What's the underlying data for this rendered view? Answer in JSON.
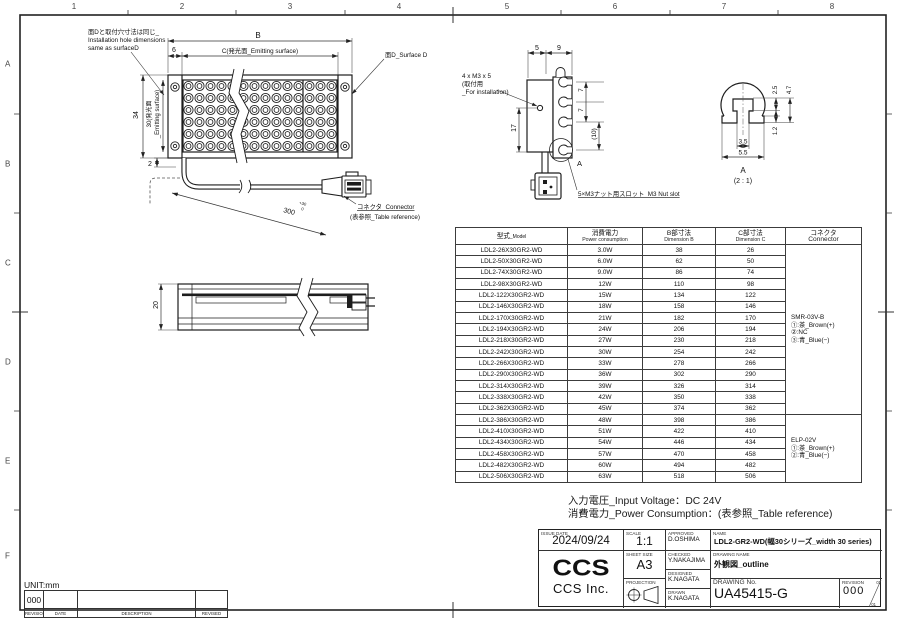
{
  "frame": {
    "col_labels": [
      "1",
      "2",
      "3",
      "4",
      "5",
      "6",
      "7",
      "8"
    ],
    "row_labels": [
      "A",
      "B",
      "C",
      "D",
      "E",
      "F"
    ]
  },
  "labels": {
    "install_note_1": "面Dと取付穴寸法は同じ_",
    "install_note_2": "Installation hole dimensions",
    "install_note_3": "same as surfaceD",
    "surface_d": "面D_Surface D",
    "connector": "コネクタ_Connector",
    "connector_ref": "(表参照_Table reference)",
    "m3_1": "4 x M3 x 5",
    "m3_2": "(取付用",
    "m3_3": "_For installation)",
    "nut_slot": "5×M3ナット用スロット_M3 Nut slot",
    "section_a": "A",
    "detail_a": "A",
    "detail_scale": "(2 : 1)"
  },
  "dims": {
    "b": "B",
    "c": "C(発光面_Emitting surface)",
    "offset6": "6",
    "h34": "34",
    "h30_l1": "30(発光面",
    "h30_l2": "_Emitting surface)",
    "h2": "2",
    "cable_len": "300",
    "cable_tol_up": "+30",
    "cable_tol_dn": "0",
    "t20": "20",
    "s5": "5",
    "s9": "9",
    "s17": "17",
    "s7a": "7",
    "s7b": "7",
    "s10": "(10)",
    "d25": "2.5",
    "d47": "4.7",
    "d12": "1.2",
    "d35": "3.5",
    "d55": "5.5"
  },
  "table": {
    "headers": [
      {
        "jp": "型式",
        "en": "_Model"
      },
      {
        "jp": "消費電力",
        "en": "Power consumption"
      },
      {
        "jp": "B部寸法",
        "en": "Dimension B"
      },
      {
        "jp": "C部寸法",
        "en": "Dimension C"
      },
      {
        "jp": "コネクタ",
        "en": "Connector"
      }
    ],
    "rows": [
      [
        "LDL2-26X30GR2-WD",
        "3.0W",
        "38",
        "26"
      ],
      [
        "LDL2-50X30GR2-WD",
        "6.0W",
        "62",
        "50"
      ],
      [
        "LDL2-74X30GR2-WD",
        "9.0W",
        "86",
        "74"
      ],
      [
        "LDL2-98X30GR2-WD",
        "12W",
        "110",
        "98"
      ],
      [
        "LDL2-122X30GR2-WD",
        "15W",
        "134",
        "122"
      ],
      [
        "LDL2-146X30GR2-WD",
        "18W",
        "158",
        "146"
      ],
      [
        "LDL2-170X30GR2-WD",
        "21W",
        "182",
        "170"
      ],
      [
        "LDL2-194X30GR2-WD",
        "24W",
        "206",
        "194"
      ],
      [
        "LDL2-218X30GR2-WD",
        "27W",
        "230",
        "218"
      ],
      [
        "LDL2-242X30GR2-WD",
        "30W",
        "254",
        "242"
      ],
      [
        "LDL2-266X30GR2-WD",
        "33W",
        "278",
        "266"
      ],
      [
        "LDL2-290X30GR2-WD",
        "36W",
        "302",
        "290"
      ],
      [
        "LDL2-314X30GR2-WD",
        "39W",
        "326",
        "314"
      ],
      [
        "LDL2-338X30GR2-WD",
        "42W",
        "350",
        "338"
      ],
      [
        "LDL2-362X30GR2-WD",
        "45W",
        "374",
        "362"
      ],
      [
        "LDL2-386X30GR2-WD",
        "48W",
        "398",
        "386"
      ],
      [
        "LDL2-410X30GR2-WD",
        "51W",
        "422",
        "410"
      ],
      [
        "LDL2-434X30GR2-WD",
        "54W",
        "446",
        "434"
      ],
      [
        "LDL2-458X30GR2-WD",
        "57W",
        "470",
        "458"
      ],
      [
        "LDL2-482X30GR2-WD",
        "60W",
        "494",
        "482"
      ],
      [
        "LDL2-506X30GR2-WD",
        "63W",
        "518",
        "506"
      ]
    ],
    "connector_groups": [
      {
        "span": 15,
        "lines": [
          "SMR-03V-B",
          "①:茶_Brown(+)",
          "②:NC",
          "③:青_Blue(−)"
        ]
      },
      {
        "span": 6,
        "lines": [
          "ELP-02V",
          "①:茶_Brown(+)",
          "②:青_Blue(−)"
        ]
      }
    ]
  },
  "footer": {
    "line1": "入力電圧_Input Voltage：DC 24V",
    "line2": "消費電力_Power Consumption：(表参照_Table reference)"
  },
  "title_block": {
    "issue_date_label": "ISSUE DATE",
    "issue_date": "2024/09/24",
    "scale_label": "SCALE",
    "scale": "1:1",
    "approved_label": "APPROVED",
    "approved": "D.OSHIMA",
    "name_label": "NAME",
    "name": "LDL2-GR2-WD(幅30シリーズ_width 30 series)",
    "sheet_size_label": "SHEET SIZE",
    "sheet_size": "A3",
    "checked_label": "CHECKED",
    "checked": "Y.NAKAJIMA",
    "drawing_name_label": "DRAWING NAME",
    "drawing_name": "外観図_outline",
    "designed_label": "DESIGNED",
    "designed": "K.NAGATA",
    "projection_label": "PROJECTION",
    "drawn_label": "DRAWN",
    "drawn": "K.NAGATA",
    "drawing_no_label": "DRAWING No.",
    "drawing_no": "UA45415-G",
    "revision_label": "REVISION",
    "revision": "000",
    "rev_top": "01",
    "rev_bottom": "01",
    "logo": "CCS",
    "company": "CCS Inc."
  },
  "unit_strip": {
    "unit": "UNIT:mm",
    "revision": "000",
    "revision_label": "REVISION",
    "date_label": "DATE",
    "description_label": "DESCRIPTION",
    "revised_label": "REVISED"
  }
}
